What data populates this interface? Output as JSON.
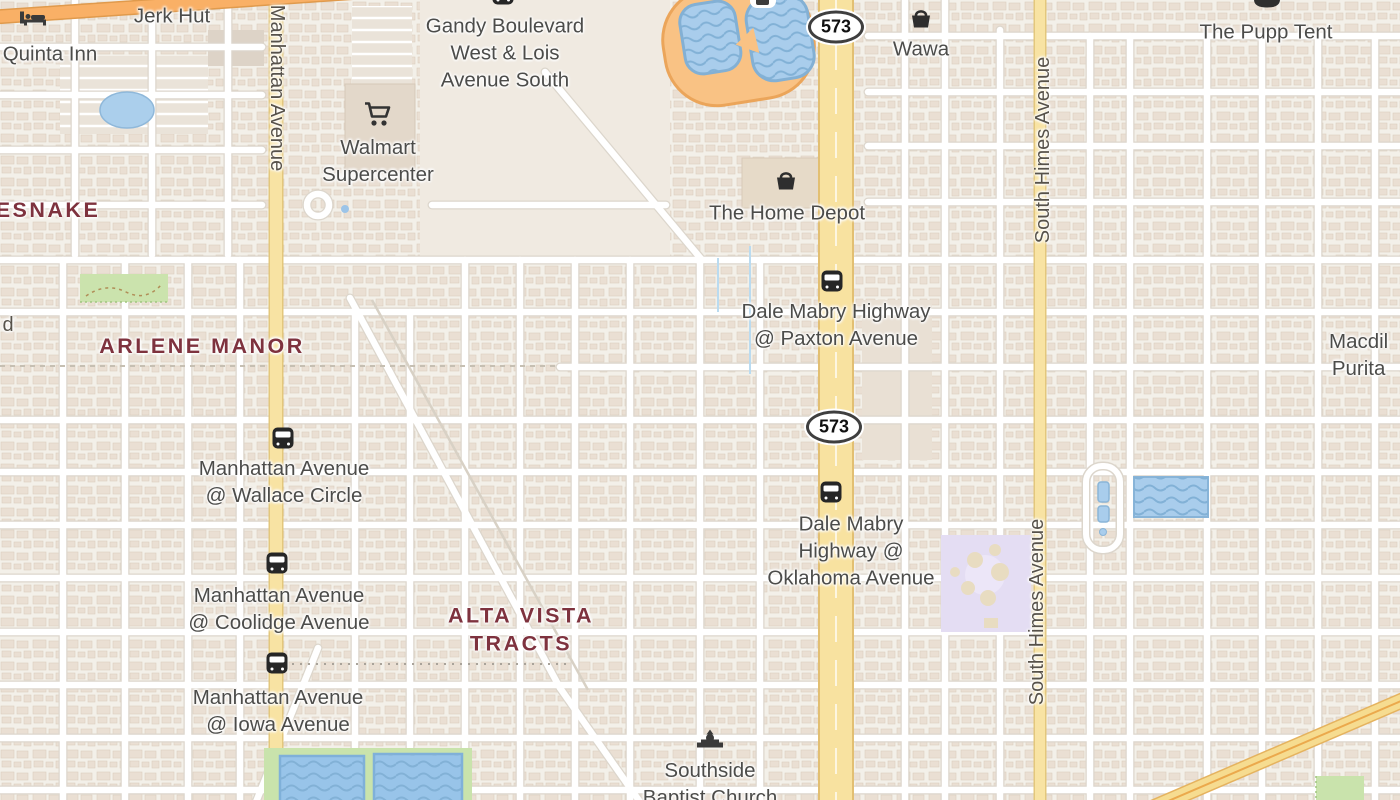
{
  "map": {
    "region_hint": "street map",
    "colors": {
      "background": "#f3f0e9",
      "building": "#eadfd3",
      "road_white": "#ffffff",
      "road_casing": "#dcd6cc",
      "secondary_yellow": "#f8e3a3",
      "trunk_orange": "#f9b066",
      "track_orange": "#f9c284",
      "water": "#a9cdec",
      "green": "#c9e3ac",
      "school_purple": "#e4ddf3",
      "poi_text": "#4c4c4a",
      "neighborhood_text": "#7e323e",
      "street_text": "#57524a"
    }
  },
  "shields": {
    "route_573": "573"
  },
  "streets": {
    "manhattan_avenue": "Manhattan Avenue",
    "south_himes_avenue": "South Himes Avenue",
    "partial_left": "d"
  },
  "neighborhoods": {
    "rattlesnake_partial": "ESNAKE",
    "arlene_manor": "ARLENE MANOR",
    "alta_vista_tracts": "ALTA VISTA\nTRACTS"
  },
  "pois": {
    "jerk_hut": "Jerk Hut",
    "quinta_inn": "Quinta Inn",
    "walmart": "Walmart\nSupercenter",
    "wawa": "Wawa",
    "home_depot": "The Home Depot",
    "pupp_tent": "The Pupp Tent",
    "southside_baptist": "Southside\nBaptist Church",
    "macdill_partial": "Macdil\nPurita"
  },
  "bus_stops": {
    "gandy_lois": "Gandy Boulevard\nWest & Lois\nAvenue South",
    "paxton": "Dale Mabry Highway\n@ Paxton Avenue",
    "wallace": "Manhattan Avenue\n@ Wallace Circle",
    "oklahoma": "Dale Mabry\nHighway @\nOklahoma Avenue",
    "coolidge": "Manhattan Avenue\n@ Coolidge Avenue",
    "iowa": "Manhattan Avenue\n@ Iowa Avenue"
  }
}
